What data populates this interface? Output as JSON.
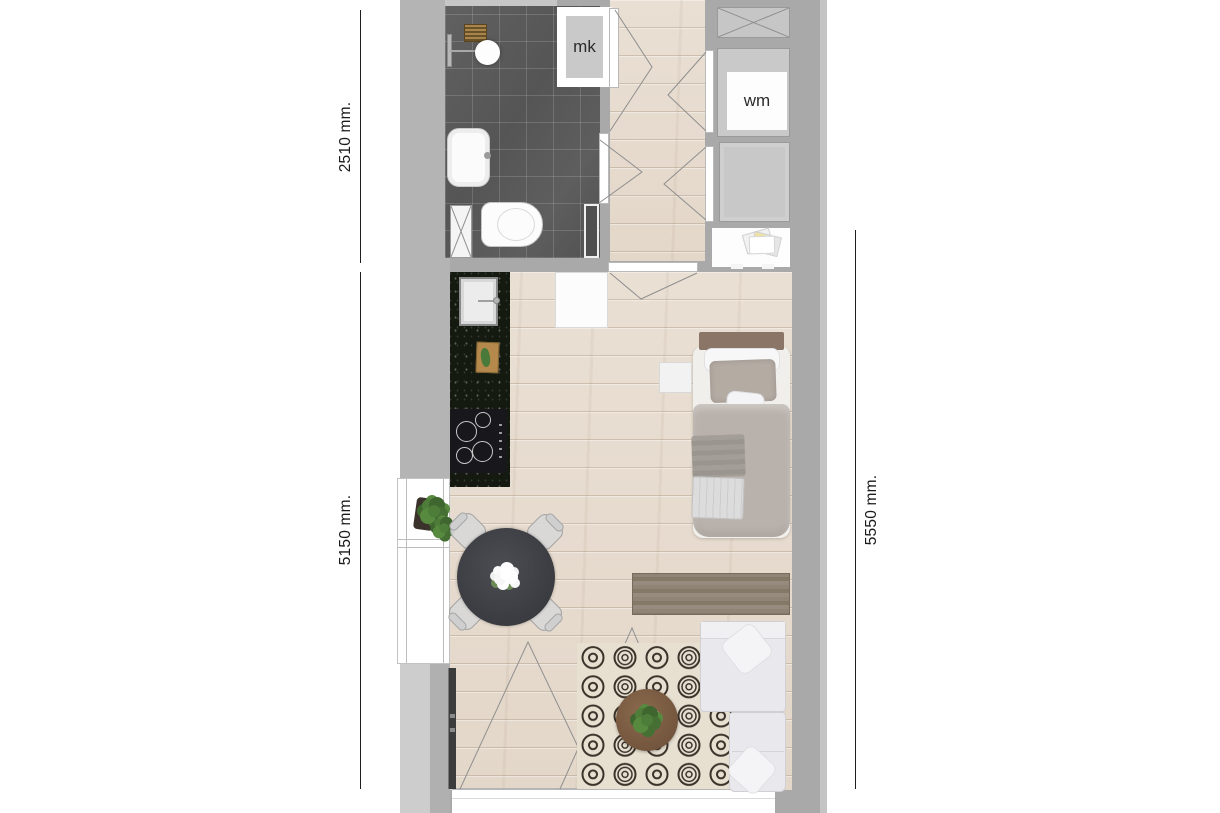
{
  "floorplan": {
    "labels": {
      "meter_cupboard": "mk",
      "washing_machine": "wm"
    },
    "dimensions": {
      "top_left": "2510 mm.",
      "bottom_left": "5150 mm.",
      "right": "5550 mm."
    },
    "colors": {
      "wall": "#a9a9a9",
      "wall_light": "#c6c6c6",
      "wood_floor": "#e7ddd0",
      "bathroom_tile": "#5c5c5c",
      "kitchen_counter": "#151a11",
      "rug_base": "#e7e0d1",
      "rug_ring": "#3b332a",
      "sideboard_wood": "#8b8071",
      "sofa": "#e9e9ed",
      "bed_duvet": "#b9b1ab",
      "dimension_text": "#1b1b1b"
    }
  }
}
